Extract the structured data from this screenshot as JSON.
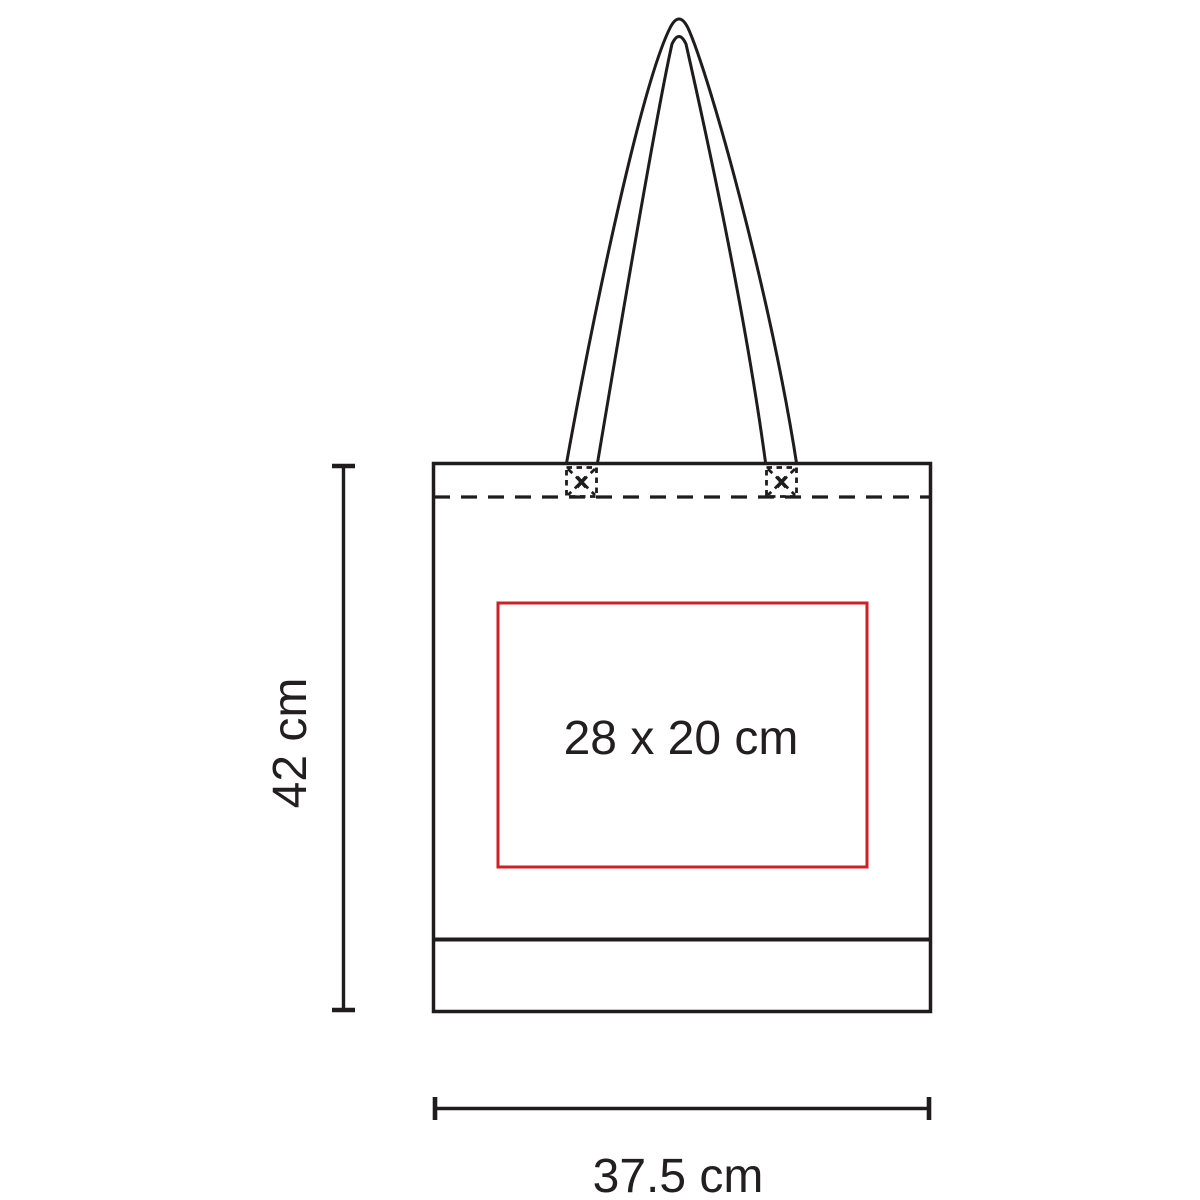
{
  "diagram": {
    "bag": {
      "height_label": "42 cm",
      "width_label": "37.5 cm",
      "print_area_label": "28 x 20 cm"
    },
    "colors": {
      "line": "#1e1c1c",
      "text": "#231f20",
      "print_area": "#cc2127",
      "background": "#ffffff"
    }
  }
}
